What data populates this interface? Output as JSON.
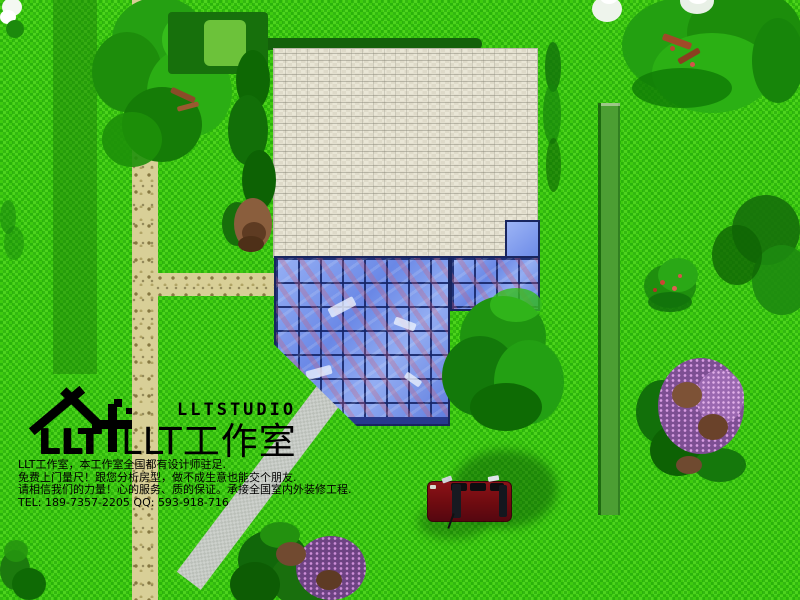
{
  "branding": {
    "logo_text": "LLT",
    "studio_name_latin": "LLTSTUDIO",
    "studio_name_cjk": "LLT工作室"
  },
  "info": {
    "lines": [
      "LLT工作室，本工作室全国都有设计师驻足.",
      "免费上门量尺！跟您分析房型，做不成生意也能交个朋友.",
      "请相信我们的力量！心的服务、质的保证。承接全国室内外装修工程.",
      "TEL: 189-7357-2205 QQ: 593-918-716"
    ]
  },
  "palette": {
    "grass_green": "#3ecb10",
    "grass_dark": "#129602",
    "mowed_stripe": "#2f8a14",
    "gravel_path": "#d8cf97",
    "concrete_path": "#cdd1cc",
    "roof_tile_cream": "#e9e6d6",
    "glass_blue_light": "#96b0f4",
    "glass_blue_dark": "#5d7bdd",
    "glass_grid_navy": "#18255f",
    "hedge_green": "#4c9e33",
    "car_red": "#7c1016",
    "tree_green": "#1f9410",
    "tree_purple": "#7d4f93",
    "flower_white": "#f2f6f0",
    "logo_black": "#000000"
  }
}
